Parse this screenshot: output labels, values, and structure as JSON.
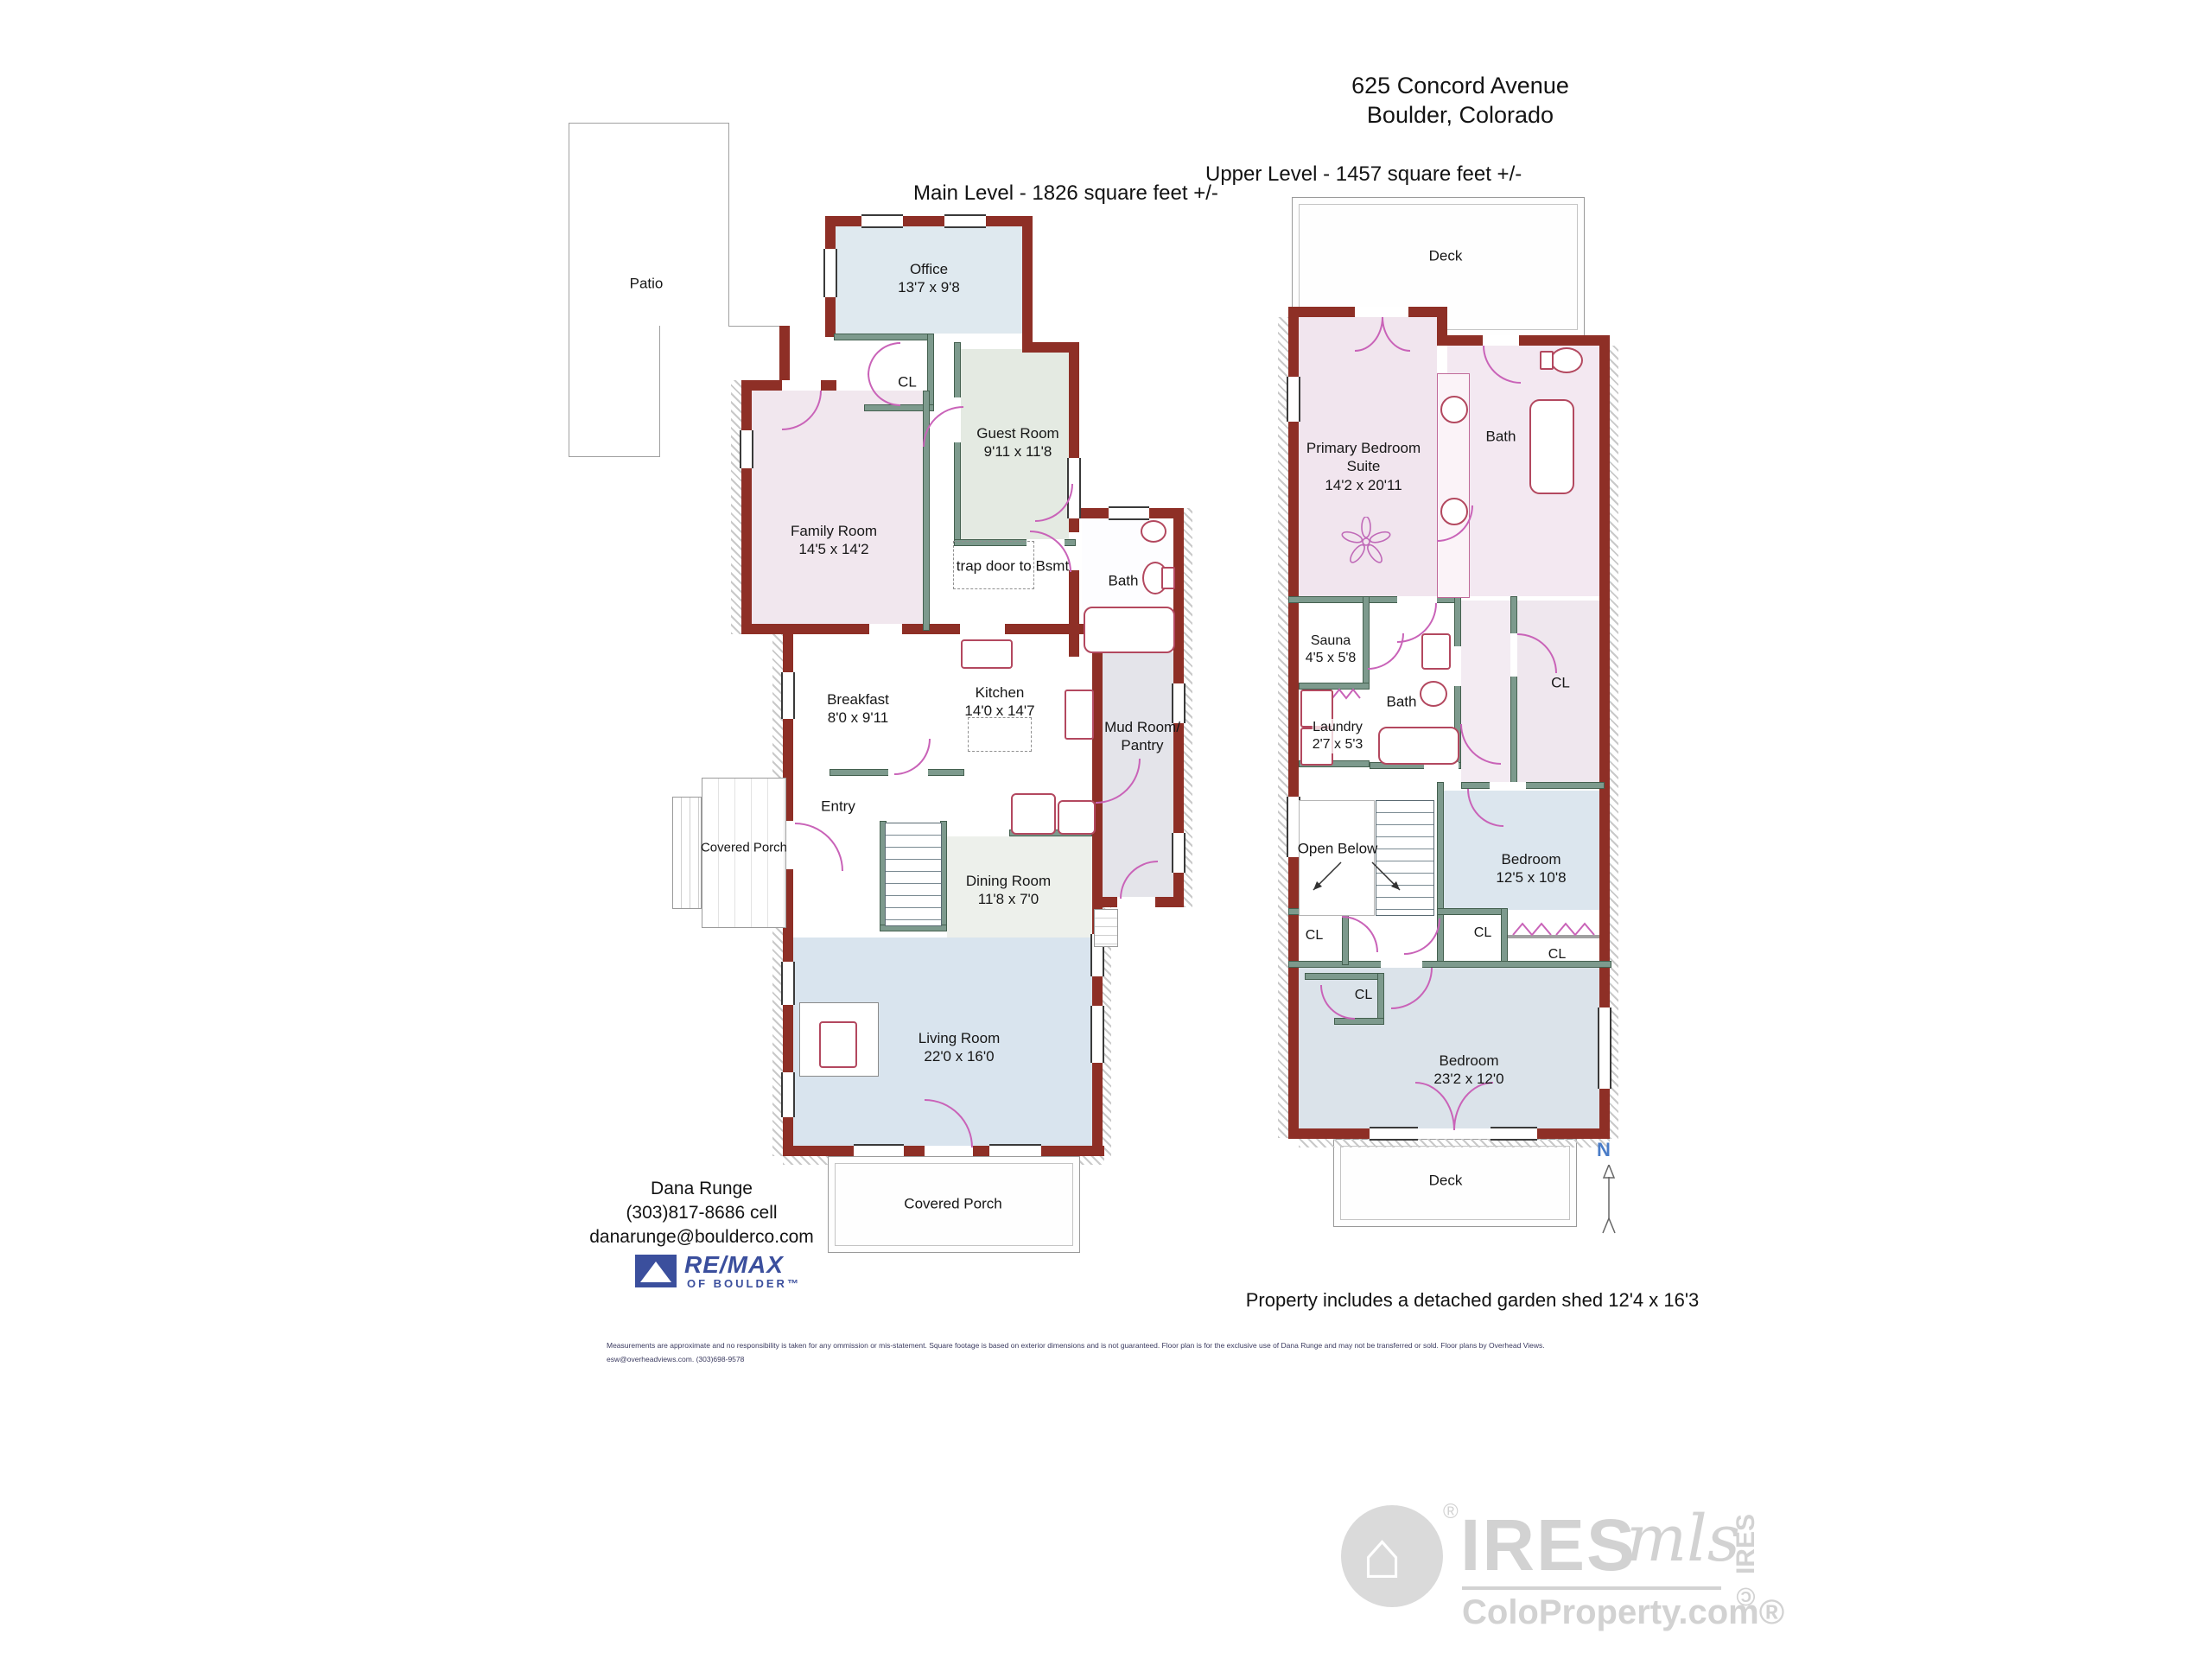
{
  "header": {
    "address_line1": "625 Concord Avenue",
    "address_line2": "Boulder, Colorado"
  },
  "main": {
    "title": "Main Level - 1826 square feet +/-",
    "rooms": [
      {
        "id": "patio",
        "lines": [
          "Patio"
        ]
      },
      {
        "id": "office",
        "lines": [
          "Office",
          "13'7 x 9'8"
        ]
      },
      {
        "id": "closet",
        "lines": [
          "CL"
        ]
      },
      {
        "id": "guest-room",
        "lines": [
          "Guest Room",
          "9'11 x 11'8"
        ]
      },
      {
        "id": "family-room",
        "lines": [
          "Family Room",
          "14'5 x 14'2"
        ]
      },
      {
        "id": "trap-door",
        "lines": [
          "trap door to Bsmt"
        ]
      },
      {
        "id": "bath",
        "lines": [
          "Bath"
        ]
      },
      {
        "id": "breakfast",
        "lines": [
          "Breakfast",
          "8'0 x 9'11"
        ]
      },
      {
        "id": "kitchen",
        "lines": [
          "Kitchen",
          "14'0 x 14'7"
        ]
      },
      {
        "id": "mud-room",
        "lines": [
          "Mud Room/",
          "Pantry"
        ]
      },
      {
        "id": "entry",
        "lines": [
          "Entry"
        ]
      },
      {
        "id": "covered-porch-west",
        "lines": [
          "Covered Porch"
        ]
      },
      {
        "id": "dining-room",
        "lines": [
          "Dining Room",
          "11'8 x 7'0"
        ]
      },
      {
        "id": "living-room",
        "lines": [
          "Living Room",
          "22'0 x 16'0"
        ]
      },
      {
        "id": "covered-porch-south",
        "lines": [
          "Covered Porch"
        ]
      }
    ]
  },
  "upper": {
    "title": "Upper Level - 1457 square feet +/-",
    "rooms": [
      {
        "id": "deck-north",
        "lines": [
          "Deck"
        ]
      },
      {
        "id": "primary-bedroom",
        "lines": [
          "Primary Bedroom",
          "Suite",
          "14'2 x 20'11"
        ]
      },
      {
        "id": "bath-north",
        "lines": [
          "Bath"
        ]
      },
      {
        "id": "sauna",
        "lines": [
          "Sauna",
          "4'5 x 5'8"
        ]
      },
      {
        "id": "bath-middle",
        "lines": [
          "Bath"
        ]
      },
      {
        "id": "laundry",
        "lines": [
          "Laundry",
          "2'7 x 5'3"
        ]
      },
      {
        "id": "closet-big",
        "lines": [
          "CL"
        ]
      },
      {
        "id": "open-below",
        "lines": [
          "Open Below"
        ]
      },
      {
        "id": "bedroom-1",
        "lines": [
          "Bedroom",
          "12'5 x 10'8"
        ]
      },
      {
        "id": "closet-left",
        "lines": [
          "CL"
        ]
      },
      {
        "id": "closet-mid",
        "lines": [
          "CL"
        ]
      },
      {
        "id": "closet-right",
        "lines": [
          "CL"
        ]
      },
      {
        "id": "closet-small",
        "lines": [
          "CL"
        ]
      },
      {
        "id": "bedroom-2",
        "lines": [
          "Bedroom",
          "23'2 x 12'0"
        ]
      },
      {
        "id": "deck-south",
        "lines": [
          "Deck"
        ]
      }
    ]
  },
  "compass": {
    "north": "N"
  },
  "agent": {
    "name": "Dana Runge",
    "phone": "(303)817-8686 cell",
    "email": "danarunge@boulderco.com"
  },
  "brokerage": {
    "brand": "RE/MAX",
    "office": "OF BOULDER™"
  },
  "note": "Property includes a detached garden shed 12'4 x 16'3",
  "disclaimer": {
    "line1": "Measurements are approximate and no responsibility is taken for any ommission or mis-statement. Square footage is based on exterior dimensions and is not guaranteed. Floor plan is for the exclusive use of Dana Runge and may not be transferred or sold. Floor plans by Overhead Views.",
    "line2": "esw@overheadviews.com. (303)698-9578"
  },
  "watermark": {
    "brand": "IRES",
    "script": "mls",
    "site": "ColoProperty.com®",
    "copyright": "© IRES",
    "registered": "®"
  },
  "colors": {
    "exterior_wall": "#8e2f26",
    "interior_wall": "#7d9a8d",
    "door": "#c963b8",
    "fixture": "#b3485f",
    "remax_blue": "#3b4f9d",
    "north_blue": "#4a7cc7",
    "watermark_gray": "#d2d2d2"
  }
}
